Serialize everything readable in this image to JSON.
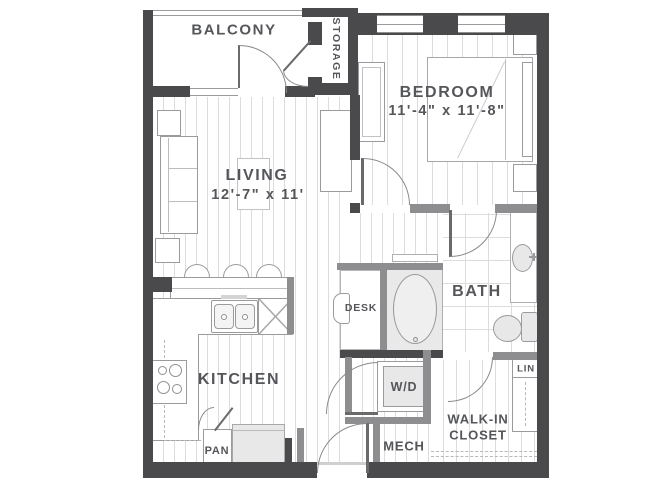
{
  "plan": {
    "title": "One bedroom apartment floor plan",
    "colors": {
      "wall_dark": "#4a4a4c",
      "wall_gray": "#8e8e90",
      "line": "#9b9b9d",
      "floor_line": "#dcdcdc",
      "fill": "#e8e8e8",
      "text": "#55565a"
    },
    "rooms": {
      "balcony": {
        "label": "BALCONY"
      },
      "storage": {
        "label": "STORAGE"
      },
      "bedroom": {
        "label": "BEDROOM",
        "dims": "11'-4\" x 11'-8\""
      },
      "living": {
        "label": "LIVING",
        "dims": "12'-7\" x 11'"
      },
      "kitchen": {
        "label": "KITCHEN"
      },
      "bath": {
        "label": "BATH"
      },
      "desk": {
        "label": "DESK"
      },
      "wd": {
        "label": "W/D"
      },
      "mech": {
        "label": "MECH"
      },
      "walkin": {
        "label_line1": "WALK-IN",
        "label_line2": "CLOSET"
      },
      "lin": {
        "label": "LIN"
      },
      "pan": {
        "label": "PAN"
      }
    }
  }
}
